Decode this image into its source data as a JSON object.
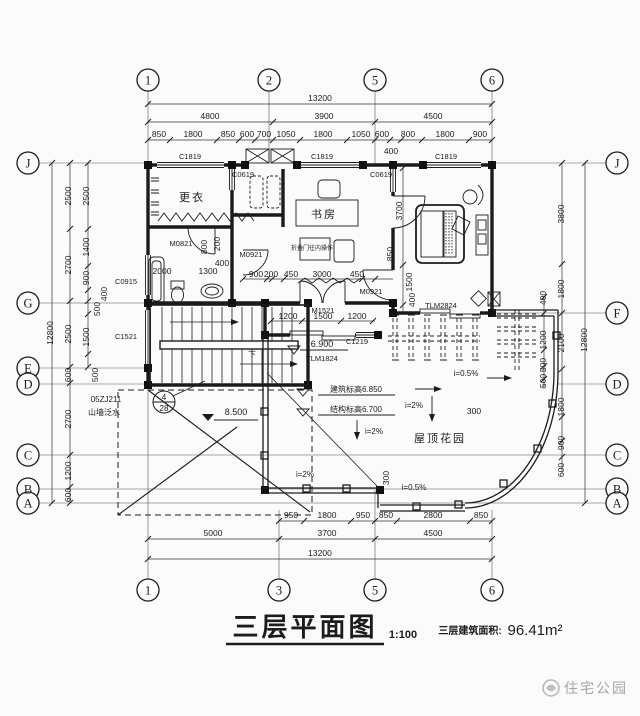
{
  "colors": {
    "ink": "#1c1c1c",
    "paper": "#fbfbfb",
    "watermark_gray": "#a3a3a3"
  },
  "grid": {
    "top": [
      "1",
      "2",
      "5",
      "6"
    ],
    "bottom": [
      "1",
      "3",
      "5",
      "6"
    ],
    "left": [
      "J",
      "G",
      "E",
      "D",
      "C",
      "B",
      "A"
    ],
    "right": [
      "J",
      "F",
      "D",
      "C",
      "B",
      "A"
    ]
  },
  "dims_top": {
    "overall": "13200",
    "bays": [
      "4800",
      "3900",
      "4500"
    ],
    "seg": [
      "850",
      "1800",
      "850",
      "600",
      "700",
      "1050",
      "1800",
      "1050",
      "600",
      "800",
      "1800",
      "900"
    ],
    "sub": "400"
  },
  "dims_bottom": {
    "overall": "13200",
    "bays": [
      "5000",
      "3700",
      "4500"
    ],
    "seg": [
      "950",
      "1800",
      "950",
      "850",
      "2800",
      "850"
    ]
  },
  "dims_left": {
    "overall": "12800",
    "mid": [
      "2500",
      "2700",
      "2500",
      "600",
      "2700",
      "1200",
      "600"
    ],
    "inner": [
      "2500",
      "1400",
      "900",
      "400",
      "500",
      "1500",
      "500"
    ]
  },
  "dims_right": {
    "overall": "12800",
    "mid": [
      "3800",
      "1800",
      "2100",
      "1800",
      "900",
      "600"
    ],
    "inner": [
      "400",
      "1200",
      "500",
      "500"
    ]
  },
  "dims_interior": {
    "bath": [
      "2000",
      "1300",
      "800",
      "200",
      "400"
    ],
    "hall": [
      "900",
      "200",
      "450",
      "3000",
      "450"
    ],
    "door_row": [
      "1200",
      "1500",
      "1200"
    ],
    "bedroom": [
      "3700",
      "850",
      "1500",
      "400"
    ],
    "garden": [
      "300",
      "300"
    ]
  },
  "windows": {
    "c1819": "C1819",
    "c0619": "C0619",
    "c0915": "C0915",
    "c1521": "C1521",
    "c1219": "C1219"
  },
  "doors": {
    "m0821": "M0821",
    "m0921": "M0921",
    "m1521": "M1521",
    "tlm1824": "TLM1824",
    "tlm2824": "TLM2824"
  },
  "rooms": {
    "dressing": "更衣",
    "study": "书房",
    "roof_garden": "屋顶花园"
  },
  "annotations": {
    "elev_roof": "8.500",
    "elev_terrace": "6.900",
    "elev_build": "建筑标高6.850",
    "elev_struct": "结构标高6.700",
    "slope2": "i=2%",
    "slope05": "i=0.5%",
    "down": "下",
    "study_note": "折叠门往内操作",
    "detail_num": "4",
    "detail_page": "28",
    "detail_code": "05ZJ211",
    "detail_name": "山墙泛水"
  },
  "title_block": {
    "title": "三层平面图",
    "scale": "1:100",
    "area_label": "三层建筑面积:",
    "area_value": "96.41m²"
  },
  "watermark": {
    "text": "住宅公园"
  }
}
